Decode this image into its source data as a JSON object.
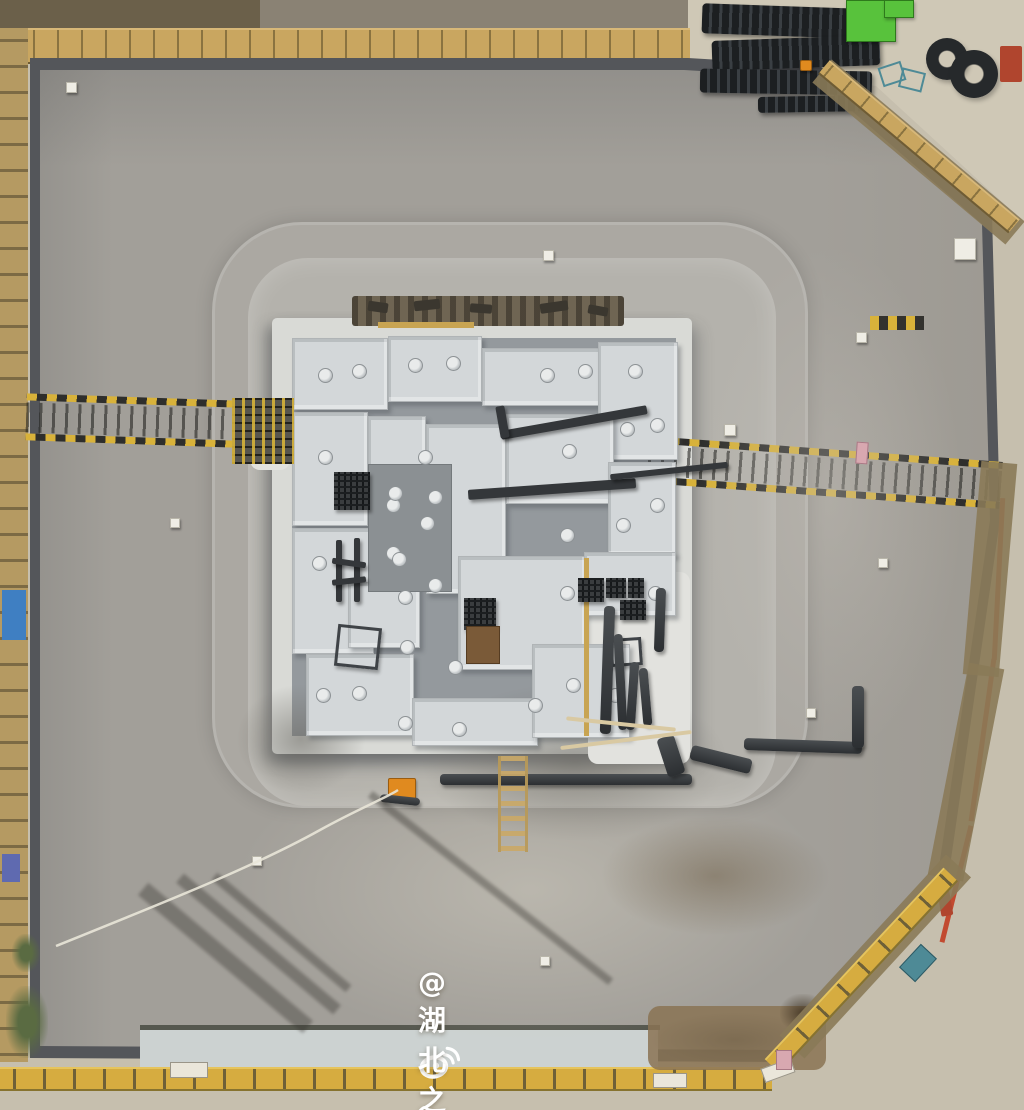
{
  "watermark": {
    "handle": "@湖北之声",
    "icon": "weibo-eye-icon",
    "color": "#ffffff"
  },
  "palette": {
    "pavement": "#c6bfae",
    "yard_concrete": "#cfc8b6",
    "pit_rim": "#54565a",
    "pit_floor": "#a29f99",
    "berm": "#b4b2ac",
    "mud_mat": "#d9dad6",
    "foundation_channel": "#94999d",
    "foundation_slab": "#d3d7d9",
    "fence_tan": "#c9a660",
    "fence_yellow": "#d6ac40",
    "dirt": "#8a7a58",
    "safety_orange": "#e08a1f",
    "machine_green": "#58c23c",
    "red_pipeline": "#c24a30",
    "watermark_white": "#ffffff"
  },
  "scene": {
    "items": [
      [
        "light-area",
        "soft1",
        240,
        740,
        580,
        300
      ],
      [
        "light-area",
        "soft2",
        700,
        250,
        260,
        500
      ],
      [
        "dirt-area",
        "dirt2",
        648,
        1006,
        178,
        64
      ],
      [
        "mud-stain",
        "stain",
        780,
        994,
        46,
        38
      ],
      [
        "wet-patch",
        "wet",
        420,
        682,
        310,
        160
      ],
      [
        "wet-patch",
        "wet",
        236,
        684,
        130,
        110
      ],
      [
        "wet-patch",
        "wet2",
        600,
        816,
        230,
        120
      ],
      [
        "wet-patch",
        "wet2",
        650,
        1012,
        170,
        56
      ],
      [
        "mud-pad",
        "mud",
        250,
        406,
        40,
        64
      ],
      [
        "mud-patch",
        "mud",
        588,
        572,
        102,
        192
      ],
      [
        "formwork-debris",
        "rustband",
        352,
        296,
        272,
        30
      ],
      [
        "debris",
        "deb",
        368,
        302,
        20,
        10,
        8
      ],
      [
        "debris",
        "deb",
        414,
        300,
        26,
        10,
        -6
      ],
      [
        "debris",
        "deb",
        470,
        304,
        22,
        9,
        4
      ],
      [
        "debris",
        "deb",
        540,
        302,
        28,
        10,
        -8
      ],
      [
        "debris",
        "deb",
        588,
        306,
        20,
        9,
        10
      ],
      [
        "concrete-slab",
        "slab",
        292,
        338,
        94,
        70
      ],
      [
        "concrete-slab",
        "slab",
        388,
        336,
        92,
        64
      ],
      [
        "concrete-slab",
        "slab",
        482,
        348,
        122,
        56
      ],
      [
        "concrete-slab",
        "slab",
        598,
        342,
        78,
        116
      ],
      [
        "concrete-slab",
        "slab",
        292,
        412,
        74,
        112
      ],
      [
        "concrete-slab",
        "slab",
        368,
        416,
        56,
        54
      ],
      [
        "concrete-slab",
        "slab",
        426,
        424,
        78,
        168
      ],
      [
        "concrete-slab",
        "slab",
        506,
        414,
        106,
        88
      ],
      [
        "concrete-slab",
        "slab",
        608,
        462,
        66,
        92
      ],
      [
        "concrete-slab",
        "slab",
        292,
        528,
        80,
        124
      ],
      [
        "concrete-slab",
        "slab",
        458,
        556,
        126,
        112
      ],
      [
        "concrete-slab",
        "slab",
        584,
        552,
        90,
        62
      ],
      [
        "concrete-slab",
        "slab",
        306,
        654,
        106,
        80
      ],
      [
        "concrete-slab",
        "slab",
        412,
        698,
        124,
        46
      ],
      [
        "concrete-slab",
        "slab",
        532,
        644,
        96,
        92
      ],
      [
        "concrete-slab",
        "slab",
        348,
        582,
        70,
        64
      ],
      [
        "mud-mat",
        "mudmat",
        368,
        464,
        82,
        126
      ],
      [
        "formwork-edge",
        "form",
        378,
        322,
        96,
        6
      ],
      [
        "formwork-edge",
        "form",
        584,
        558,
        5,
        178
      ],
      [
        "pile-cap",
        "pilecap",
        318,
        368,
        13,
        13
      ],
      [
        "pile-cap",
        "pilecap",
        352,
        364,
        13,
        13
      ],
      [
        "pile-cap",
        "pilecap",
        408,
        358,
        13,
        13
      ],
      [
        "pile-cap",
        "pilecap",
        446,
        356,
        13,
        13
      ],
      [
        "pile-cap",
        "pilecap",
        540,
        368,
        13,
        13
      ],
      [
        "pile-cap",
        "pilecap",
        578,
        364,
        13,
        13
      ],
      [
        "pile-cap",
        "pilecap",
        628,
        364,
        13,
        13
      ],
      [
        "pile-cap",
        "pilecap",
        318,
        450,
        13,
        13
      ],
      [
        "pile-cap",
        "pilecap",
        418,
        450,
        13,
        13
      ],
      [
        "pile-cap",
        "pilecap",
        562,
        444,
        13,
        13
      ],
      [
        "pile-cap",
        "pilecap",
        620,
        422,
        13,
        13
      ],
      [
        "pile-cap",
        "pilecap",
        650,
        418,
        13,
        13
      ],
      [
        "pile-cap",
        "pilecap",
        386,
        498,
        13,
        13
      ],
      [
        "pile-cap",
        "pilecap",
        312,
        556,
        13,
        13
      ],
      [
        "pile-cap",
        "pilecap",
        386,
        546,
        13,
        13
      ],
      [
        "pile-cap",
        "pilecap",
        398,
        590,
        13,
        13
      ],
      [
        "pile-cap",
        "pilecap",
        428,
        490,
        13,
        13
      ],
      [
        "pile-cap",
        "pilecap",
        560,
        528,
        13,
        13
      ],
      [
        "pile-cap",
        "pilecap",
        616,
        518,
        13,
        13
      ],
      [
        "pile-cap",
        "pilecap",
        650,
        498,
        13,
        13
      ],
      [
        "pile-cap",
        "pilecap",
        560,
        586,
        13,
        13
      ],
      [
        "pile-cap",
        "pilecap",
        606,
        582,
        13,
        13
      ],
      [
        "pile-cap",
        "pilecap",
        648,
        586,
        13,
        13
      ],
      [
        "pile-cap",
        "pilecap",
        316,
        688,
        13,
        13
      ],
      [
        "pile-cap",
        "pilecap",
        352,
        686,
        13,
        13
      ],
      [
        "pile-cap",
        "pilecap",
        398,
        716,
        13,
        13
      ],
      [
        "pile-cap",
        "pilecap",
        452,
        722,
        13,
        13
      ],
      [
        "pile-cap",
        "pilecap",
        528,
        698,
        13,
        13
      ],
      [
        "pile-cap",
        "pilecap",
        566,
        678,
        13,
        13
      ],
      [
        "pile-cap",
        "pilecap",
        608,
        688,
        13,
        13
      ],
      [
        "pile-cap",
        "pilecap",
        388,
        486,
        13,
        13
      ],
      [
        "pile-cap",
        "pilecap",
        420,
        516,
        13,
        13
      ],
      [
        "pile-cap",
        "pilecap",
        392,
        552,
        13,
        13
      ],
      [
        "pile-cap",
        "pilecap",
        428,
        578,
        13,
        13
      ],
      [
        "pile-cap",
        "pilecap",
        400,
        640,
        13,
        13
      ],
      [
        "pile-cap",
        "pilecap",
        448,
        660,
        13,
        13
      ],
      [
        "steel-beam",
        "beam",
        500,
        418,
        148,
        9,
        -10
      ],
      [
        "steel-beam",
        "beam",
        498,
        406,
        9,
        32,
        -10
      ],
      [
        "steel-beam",
        "beam",
        468,
        484,
        168,
        10,
        -4
      ],
      [
        "steel-beam",
        "beam",
        610,
        468,
        118,
        6,
        -6
      ],
      [
        "steel-post",
        "beam",
        336,
        540,
        6,
        62
      ],
      [
        "steel-post",
        "beam",
        354,
        538,
        6,
        64
      ],
      [
        "steel-beam",
        "beam",
        332,
        560,
        34,
        6,
        8
      ],
      [
        "steel-beam",
        "beam",
        332,
        578,
        34,
        6,
        -6
      ],
      [
        "steel-frame",
        "frame",
        336,
        626,
        38,
        36,
        6
      ],
      [
        "steel-frame",
        "frame",
        610,
        638,
        26,
        22,
        -4
      ],
      [
        "rebar-cage",
        "cage",
        334,
        472,
        36,
        38
      ],
      [
        "rebar-cage",
        "cage",
        464,
        598,
        32,
        32
      ],
      [
        "rebar-cage",
        "cage",
        578,
        578,
        26,
        24
      ],
      [
        "rebar-cage",
        "cage",
        606,
        578,
        20,
        20
      ],
      [
        "rebar-cage",
        "cage",
        628,
        578,
        16,
        20
      ],
      [
        "rebar-cage",
        "cage",
        620,
        600,
        26,
        20
      ],
      [
        "rust-box",
        "rust",
        466,
        626,
        32,
        36
      ],
      [
        "steel-pipe",
        "pipe",
        602,
        606,
        11,
        128,
        2
      ],
      [
        "steel-pipe",
        "pipe",
        616,
        634,
        9,
        96,
        -3
      ],
      [
        "steel-pipe",
        "pipe",
        628,
        662,
        9,
        68,
        4
      ],
      [
        "steel-pipe",
        "pipe",
        641,
        668,
        9,
        58,
        -5
      ],
      [
        "steel-pipe",
        "pipe",
        655,
        588,
        10,
        64,
        2
      ],
      [
        "drain-pipe",
        "pipe",
        440,
        774,
        252,
        11
      ],
      [
        "drain-pipe",
        "pipe",
        690,
        752,
        62,
        15,
        14
      ],
      [
        "drain-pipe",
        "pipe",
        744,
        740,
        118,
        12,
        2
      ],
      [
        "drain-pipe",
        "pipe",
        852,
        686,
        12,
        62
      ],
      [
        "drain-pipe",
        "pipe",
        662,
        736,
        18,
        40,
        -18
      ],
      [
        "rope",
        "rope",
        560,
        738,
        132,
        4,
        -7
      ],
      [
        "rope",
        "rope",
        566,
        722,
        110,
        4,
        6
      ],
      [
        "ladder",
        "ladder",
        498,
        756,
        24,
        96
      ],
      [
        "pump",
        "orangepump",
        388,
        778,
        26,
        20
      ],
      [
        "pump-hose",
        "pipe",
        380,
        796,
        40,
        8,
        6
      ],
      [
        "scaffold-rack",
        "rack",
        232,
        398,
        62,
        66
      ],
      [
        "rebar-bundle",
        "bundle",
        702,
        6,
        158,
        30,
        2
      ],
      [
        "rebar-bundle",
        "bundle",
        712,
        38,
        168,
        30,
        -2
      ],
      [
        "rebar-bundle",
        "bundle",
        700,
        70,
        172,
        24,
        1
      ],
      [
        "rebar-bundle",
        "bundle",
        758,
        96,
        112,
        16,
        -1
      ],
      [
        "green-lift",
        "green",
        846,
        0,
        48,
        40
      ],
      [
        "green-lift",
        "green",
        884,
        0,
        28,
        16
      ],
      [
        "wire-coil",
        "coil",
        926,
        38,
        42,
        42
      ],
      [
        "wire-coil",
        "coil",
        950,
        50,
        48,
        48
      ],
      [
        "steel-stand",
        "teal",
        880,
        64,
        20,
        16,
        -18
      ],
      [
        "steel-stand",
        "teal",
        900,
        70,
        20,
        16,
        14
      ],
      [
        "red-equipment",
        "red",
        1000,
        46,
        22,
        36
      ],
      [
        "warning-light",
        "orangepump",
        800,
        60,
        10,
        9
      ],
      [
        "red-pipeline",
        "redline",
        996,
        498,
        5,
        162,
        3
      ],
      [
        "red-pipeline",
        "redline",
        980,
        658,
        5,
        164,
        8
      ],
      [
        "red-pipeline",
        "redline",
        954,
        824,
        5,
        120,
        14
      ],
      [
        "equipment-box",
        "marker",
        954,
        238,
        20,
        20
      ],
      [
        "short-walkway",
        "walkdash",
        870,
        316,
        54,
        14
      ],
      [
        "sign-board",
        "tealfill",
        902,
        952,
        30,
        20,
        -47
      ],
      [
        "red-post",
        "red",
        938,
        876,
        12,
        40,
        -10
      ],
      [
        "dirt-berm",
        "dirt",
        972,
        462,
        36,
        214,
        5
      ],
      [
        "dirt-berm",
        "dirt",
        948,
        664,
        36,
        216,
        11
      ],
      [
        "dirt-berm",
        "dirt",
        792,
        1030,
        246,
        34,
        -47.4,
        "left"
      ],
      [
        "dirt-berm",
        "dirt",
        822,
        56,
        252,
        30,
        40,
        "left"
      ],
      [
        "perimeter-fence",
        "fencetan",
        824,
        58,
        248,
        14,
        40,
        "left"
      ],
      [
        "perimeter-fence",
        "fenceyellow",
        772,
        1056,
        262,
        16,
        -47,
        "left"
      ],
      [
        "blue-tarp",
        "blue",
        2,
        590,
        24,
        50
      ],
      [
        "blue-tarp",
        "blue2",
        2,
        854,
        18,
        28
      ],
      [
        "vegetation",
        "veg",
        6,
        986,
        42,
        72
      ],
      [
        "vegetation",
        "veg",
        12,
        934,
        28,
        38
      ],
      [
        "sign-board",
        "whitesign",
        170,
        1062,
        36,
        14
      ],
      [
        "sign-board",
        "whitesign",
        653,
        1073,
        32,
        13
      ],
      [
        "sign-board",
        "whitesign",
        762,
        1063,
        30,
        13,
        -20
      ],
      [
        "sign-board",
        "pinksign",
        776,
        1050,
        14,
        18
      ],
      [
        "survey-marker",
        "marker",
        66,
        82,
        9,
        9
      ],
      [
        "survey-marker",
        "marker",
        543,
        250,
        9,
        9
      ],
      [
        "survey-marker",
        "marker",
        724,
        424,
        10,
        10
      ],
      [
        "survey-marker",
        "marker",
        856,
        332,
        9,
        9
      ],
      [
        "survey-marker",
        "marker",
        540,
        956,
        8,
        8
      ],
      [
        "survey-marker",
        "marker",
        252,
        856,
        8,
        8
      ],
      [
        "survey-marker",
        "marker",
        806,
        708,
        8,
        8
      ],
      [
        "survey-marker",
        "marker",
        170,
        518,
        8,
        8
      ],
      [
        "survey-marker",
        "marker",
        878,
        558,
        8,
        8
      ],
      [
        "crane-shadow",
        "shadow",
        118,
        950,
        215,
        16,
        40
      ],
      [
        "crane-shadow",
        "shadow",
        156,
        938,
        205,
        12,
        40
      ],
      [
        "crane-shadow",
        "shadow",
        194,
        928,
        175,
        9,
        40
      ],
      [
        "pole-shadow",
        "shadow",
        338,
        884,
        305,
        8,
        38
      ],
      [
        "flag",
        "pinksign",
        856,
        442,
        10,
        20,
        4
      ]
    ]
  }
}
